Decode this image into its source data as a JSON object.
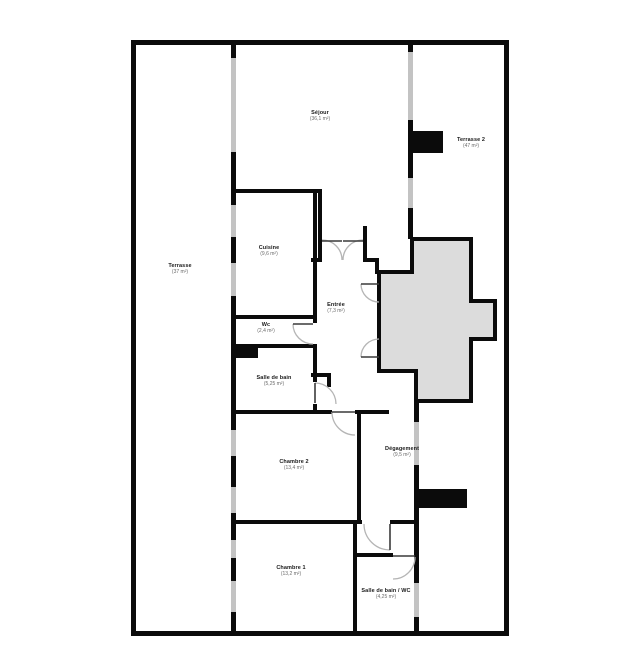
{
  "plan": {
    "theme": {
      "background": "#ffffff",
      "wall": "#0b0b0b",
      "window": "#c3c3c3",
      "cross_fill": "#dcdcdc",
      "door_arc": "#b5b5b5",
      "door_leaf": "#3a3a3a",
      "label": "#1a1a1a",
      "area_label": "#6b6b6b"
    },
    "rooms": {
      "sejour": {
        "name": "Séjour",
        "area": "(36,1 m²)"
      },
      "terrasse2": {
        "name": "Terrasse 2",
        "area": "(47 m²)"
      },
      "terrasse": {
        "name": "Terrasse",
        "area": "(37 m²)"
      },
      "cuisine": {
        "name": "Cuisine",
        "area": "(9,6 m²)"
      },
      "entree": {
        "name": "Entrée",
        "area": "(7,3 m²)"
      },
      "wc": {
        "name": "Wc",
        "area": "(2,4 m²)"
      },
      "salle_de_bain": {
        "name": "Salle de bain",
        "area": "(5,25 m²)"
      },
      "chambre2": {
        "name": "Chambre 2",
        "area": "(13,4 m²)"
      },
      "degagement": {
        "name": "Dégagement",
        "area": "(9,5 m²)"
      },
      "chambre1": {
        "name": "Chambre 1",
        "area": "(13,2 m²)"
      },
      "sdb_wc": {
        "name": "Salle de bain / WC",
        "area": "(4,25 m²)"
      }
    }
  }
}
